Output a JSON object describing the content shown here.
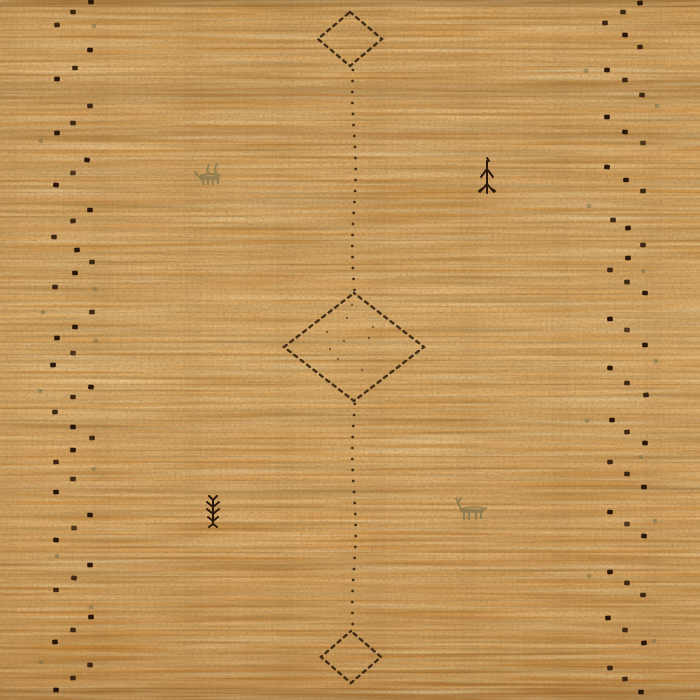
{
  "image": {
    "description": "Close-up photo of a hand-woven camel-orange Gabbeh wool rug. A vertical chain of three dashed diamond medallions runs down the center joined by a dotted line; two zigzag columns of small dark knots run along the left and right edges; tiny animal and plant motifs are scattered in the field.",
    "width": 700,
    "height": 700
  },
  "palette": {
    "base": "#cd9249",
    "base_light": "#dda55c",
    "base_dark": "#b07634",
    "weave_shadow": "#8a5a26",
    "dot_dark": "#241307",
    "dot_alt": "#3a2410",
    "outline": "#2e1d0d",
    "line_dot": "#362310",
    "motif_dark": "#2a1a0b",
    "motif_olive": "#6e6c48",
    "bottom_warm": "#c5863c"
  },
  "field": {
    "diamonds": [
      {
        "name": "diamond-top",
        "cx": 350,
        "cy": 39,
        "rx": 32,
        "ry": 27
      },
      {
        "name": "diamond-middle",
        "cx": 354,
        "cy": 347,
        "rx": 70,
        "ry": 54
      },
      {
        "name": "diamond-bottom",
        "cx": 351,
        "cy": 657,
        "rx": 30,
        "ry": 26
      }
    ],
    "center_line": {
      "x": 354,
      "segments": [
        {
          "y_start": 70,
          "y_end": 291
        },
        {
          "y_start": 404,
          "y_end": 629
        }
      ],
      "step": 11
    },
    "inner_specks": [
      [
        327,
        332
      ],
      [
        347,
        318
      ],
      [
        369,
        338
      ],
      [
        338,
        359
      ],
      [
        362,
        370
      ],
      [
        330,
        349
      ],
      [
        373,
        327
      ],
      [
        352,
        305
      ],
      [
        344,
        341
      ]
    ],
    "edge_dots": {
      "left": [
        [
          91,
          2
        ],
        [
          73,
          12
        ],
        [
          57,
          25
        ],
        [
          90,
          50
        ],
        [
          75,
          68
        ],
        [
          57,
          79
        ],
        [
          90,
          106
        ],
        [
          73,
          123
        ],
        [
          57,
          133
        ],
        [
          87,
          160
        ],
        [
          73,
          173
        ],
        [
          56,
          185
        ],
        [
          90,
          210
        ],
        [
          73,
          221
        ],
        [
          54,
          237
        ],
        [
          77,
          250
        ],
        [
          92,
          262
        ],
        [
          75,
          273
        ],
        [
          55,
          287
        ],
        [
          92,
          312
        ],
        [
          75,
          327
        ],
        [
          57,
          338
        ],
        [
          73,
          353
        ],
        [
          53,
          365
        ],
        [
          91,
          387
        ],
        [
          73,
          397
        ],
        [
          55,
          412
        ],
        [
          73,
          427
        ],
        [
          92,
          438
        ],
        [
          73,
          450
        ],
        [
          56,
          462
        ],
        [
          73,
          479
        ],
        [
          56,
          492
        ],
        [
          90,
          515
        ],
        [
          74,
          528
        ],
        [
          56,
          540
        ],
        [
          90,
          565
        ],
        [
          74,
          578
        ],
        [
          56,
          590
        ],
        [
          91,
          617
        ],
        [
          73,
          630
        ],
        [
          55,
          642
        ],
        [
          90,
          665
        ],
        [
          73,
          678
        ],
        [
          56,
          690
        ]
      ],
      "right": [
        [
          640,
          3
        ],
        [
          623,
          12
        ],
        [
          605,
          23
        ],
        [
          625,
          35
        ],
        [
          640,
          47
        ],
        [
          607,
          70
        ],
        [
          625,
          80
        ],
        [
          642,
          95
        ],
        [
          607,
          117
        ],
        [
          625,
          132
        ],
        [
          643,
          143
        ],
        [
          607,
          167
        ],
        [
          626,
          180
        ],
        [
          643,
          191
        ],
        [
          613,
          220
        ],
        [
          628,
          228
        ],
        [
          643,
          245
        ],
        [
          628,
          258
        ],
        [
          610,
          270
        ],
        [
          627,
          282
        ],
        [
          645,
          293
        ],
        [
          610,
          319
        ],
        [
          627,
          330
        ],
        [
          645,
          345
        ],
        [
          610,
          368
        ],
        [
          627,
          383
        ],
        [
          646,
          395
        ],
        [
          612,
          420
        ],
        [
          627,
          432
        ],
        [
          645,
          443
        ],
        [
          610,
          462
        ],
        [
          627,
          474
        ],
        [
          644,
          487
        ],
        [
          610,
          512
        ],
        [
          627,
          524
        ],
        [
          644,
          536
        ],
        [
          610,
          572
        ],
        [
          627,
          583
        ],
        [
          643,
          595
        ],
        [
          608,
          618
        ],
        [
          625,
          630
        ],
        [
          644,
          643
        ],
        [
          610,
          668
        ],
        [
          625,
          679
        ],
        [
          641,
          692
        ]
      ]
    },
    "olive_specks": [
      [
        94,
        26
      ],
      [
        41,
        141
      ],
      [
        95,
        289
      ],
      [
        43,
        312
      ],
      [
        96,
        341
      ],
      [
        40,
        391
      ],
      [
        94,
        469
      ],
      [
        57,
        556
      ],
      [
        91,
        607
      ],
      [
        41,
        662
      ],
      [
        586,
        71
      ],
      [
        657,
        106
      ],
      [
        589,
        206
      ],
      [
        643,
        271
      ],
      [
        656,
        361
      ],
      [
        587,
        421
      ],
      [
        641,
        457
      ],
      [
        655,
        521
      ],
      [
        589,
        576
      ],
      [
        654,
        641
      ]
    ],
    "motifs": [
      {
        "name": "goat-motif-left",
        "x": 197,
        "y": 162,
        "style": "olive"
      },
      {
        "name": "figure-motif-right-top",
        "x": 479,
        "y": 157,
        "style": "dark"
      },
      {
        "name": "plant-motif-left-bottom",
        "x": 205,
        "y": 496,
        "style": "dark"
      },
      {
        "name": "deer-motif-right-bottom",
        "x": 452,
        "y": 498,
        "style": "olive"
      }
    ]
  }
}
